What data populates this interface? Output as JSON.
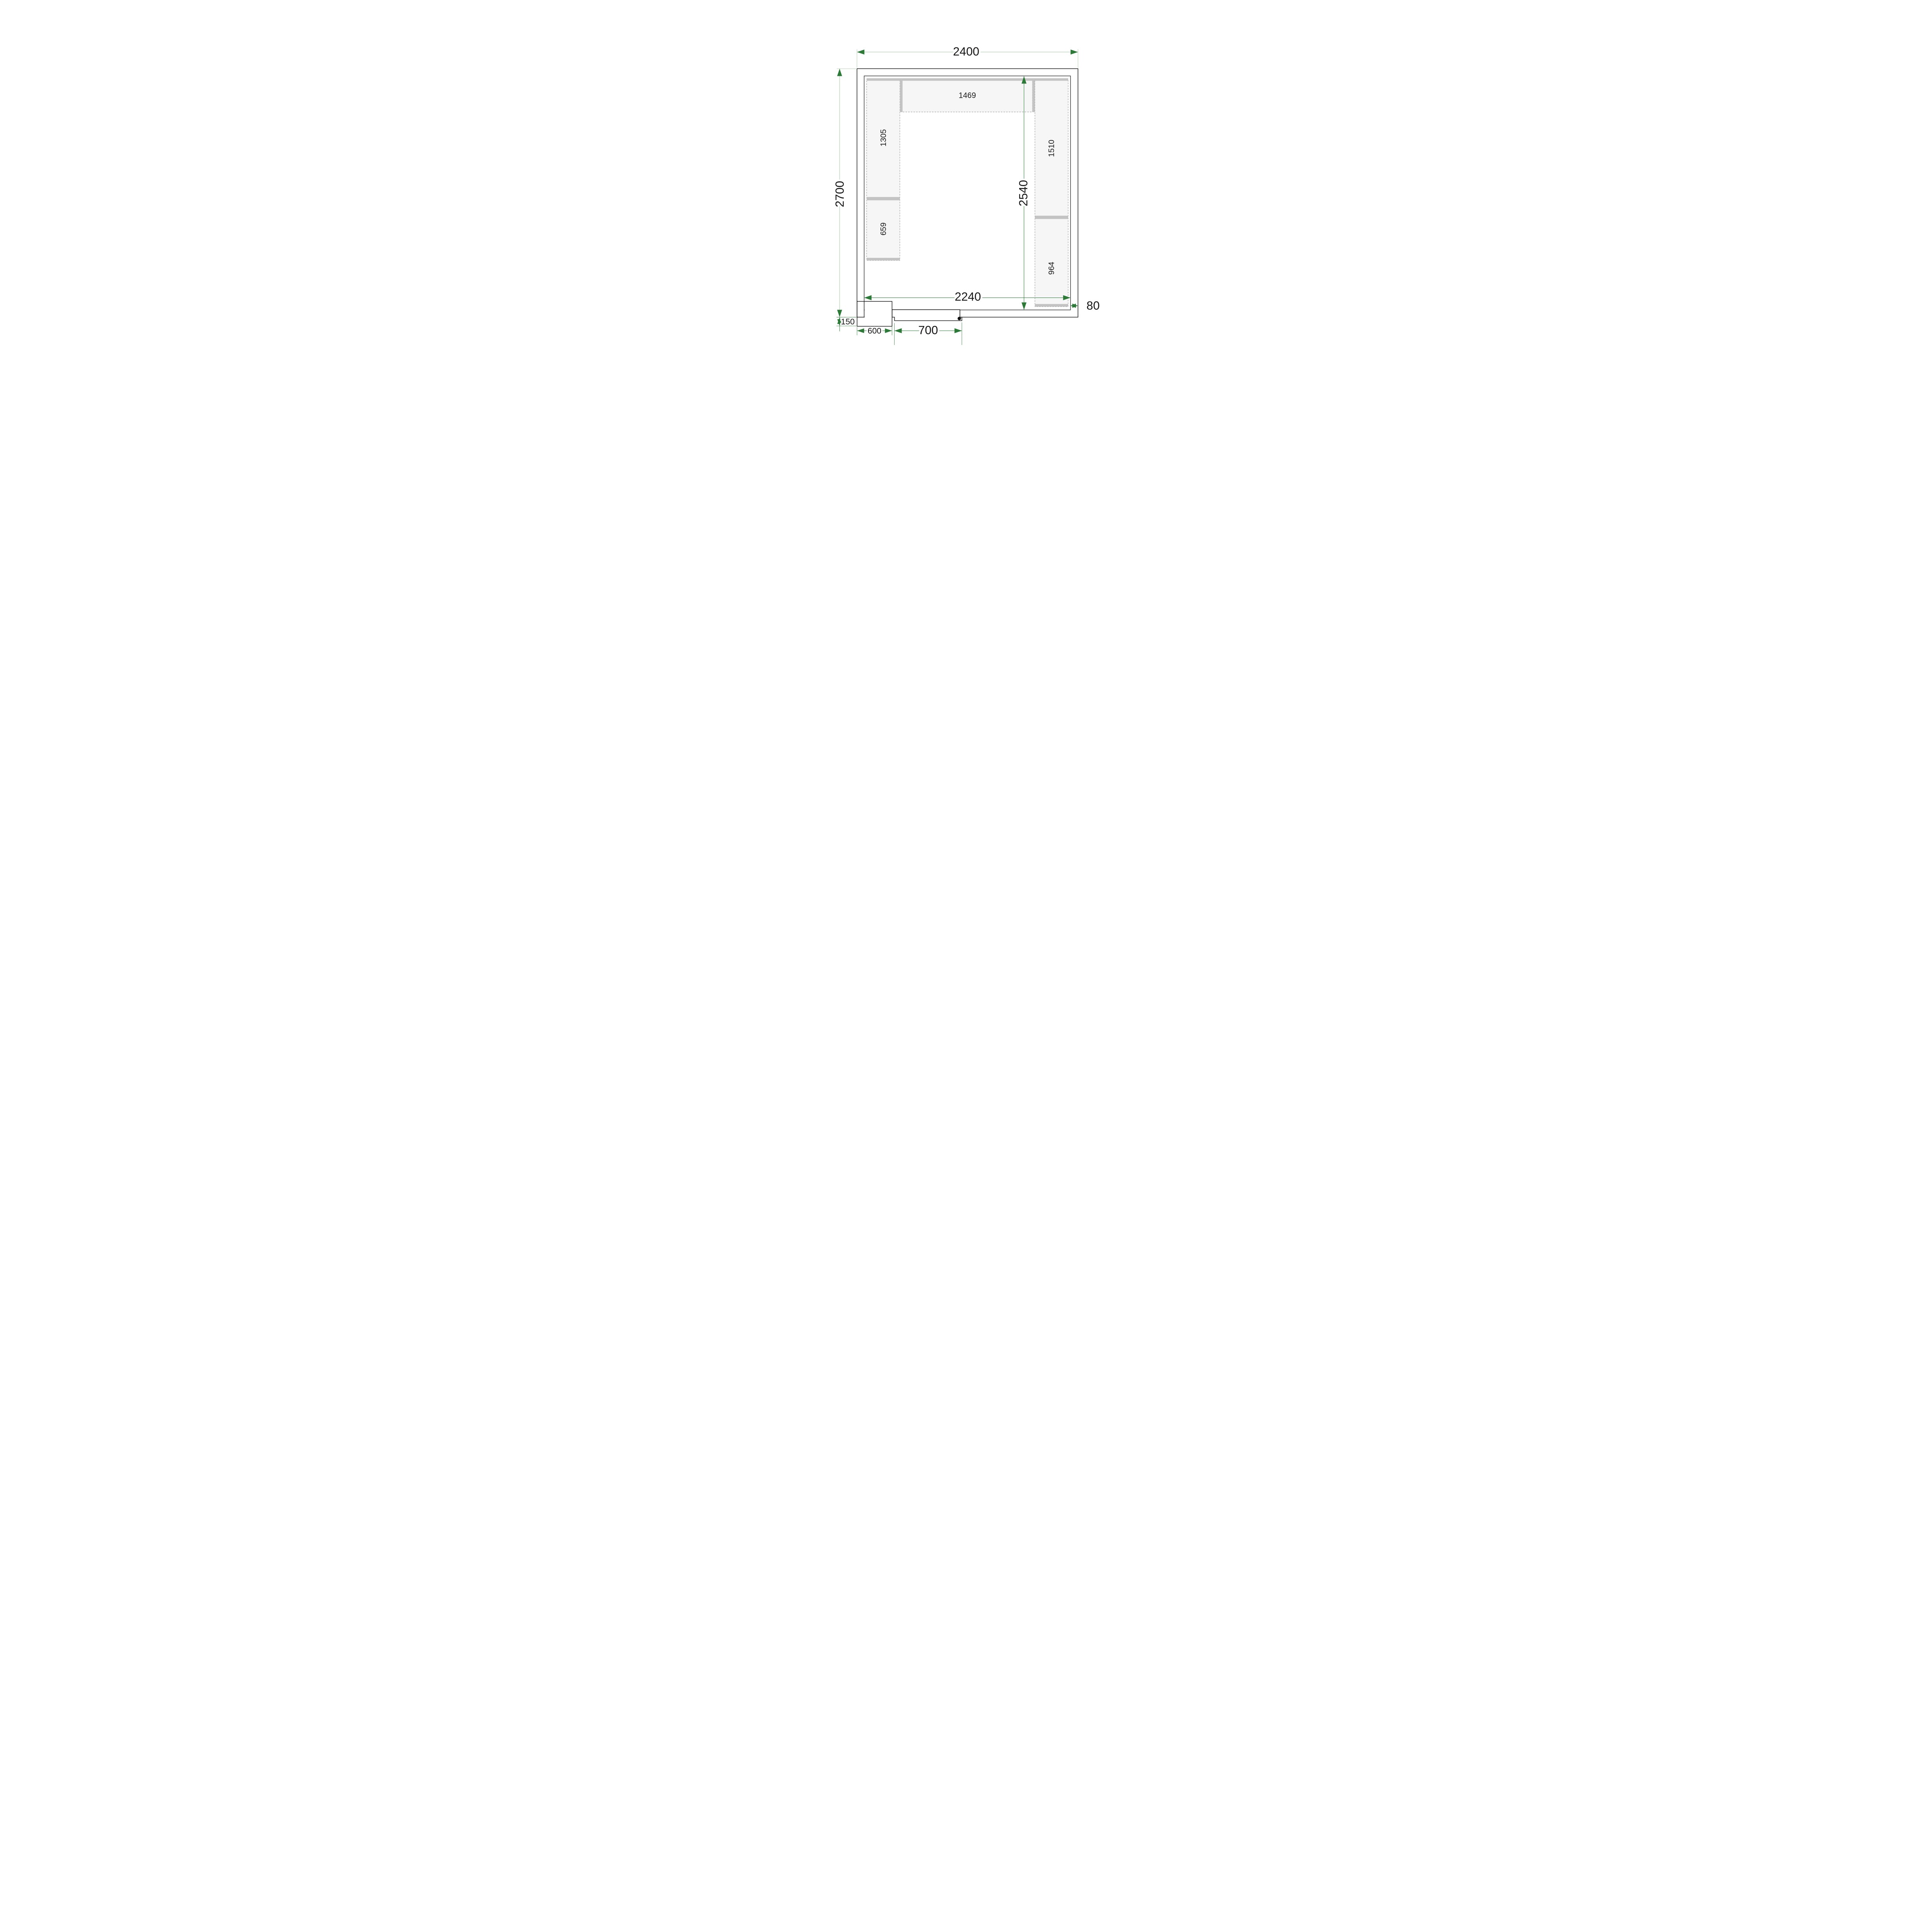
{
  "figure": {
    "type": "cold-room-floor-plan-top-view",
    "units": "mm",
    "room": {
      "outer_width": "2400",
      "outer_height": "2700",
      "inner_width": "2240",
      "inner_height": "2540",
      "wall_thickness": "80"
    },
    "door": {
      "width": "700"
    },
    "cooling_unit": {
      "width": "600",
      "protrusion": "150"
    },
    "shelves": {
      "top_length": "1469",
      "left_upper_length": "1305",
      "left_lower_length": "659",
      "right_upper_length": "1510",
      "right_lower_length": "964"
    },
    "colors": {
      "wall_fill": "#d9d9d9",
      "interior_fill": "#ffffff",
      "outline": "#111111",
      "shelf_fill": "#f6f6f6",
      "shelf_band": "#c3c3c3",
      "shelf_dash": "#7d7d7d",
      "door_fill": "#e4e4e4",
      "dim_line_pale": "#a3c6a3",
      "dim_line_dark": "#2d7a38",
      "unit_gradient_top": "#8ec7c0",
      "unit_gradient_mid": "#c09a70",
      "unit_gradient_bottom": "#e93309"
    }
  }
}
